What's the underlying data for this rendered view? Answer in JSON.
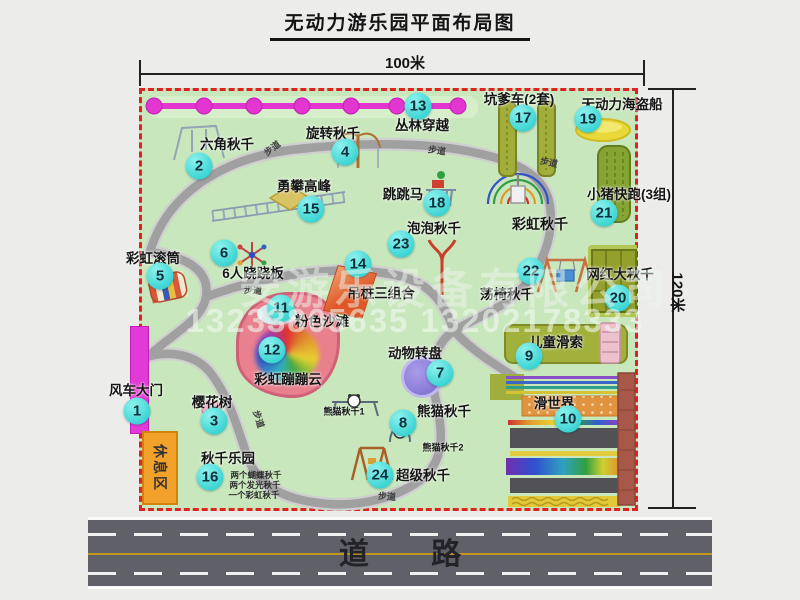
{
  "title": "无动力游乐园平面布局图",
  "dimensions": {
    "width_label": "100米",
    "height_label": "120米"
  },
  "road": {
    "label": "道 路"
  },
  "watermark": {
    "line1": "安游乐设备有限公司",
    "line2": "13233805635 13202178333"
  },
  "colors": {
    "map_bg": "#c9e7bd",
    "border_dash": "#dd2222",
    "badge": "#1cc9c9",
    "zipline": "#e335cf",
    "gate": "#e23ad6",
    "rest_area": "#f2a22b",
    "road": "#606068"
  },
  "map": {
    "rest_area_label": "休息区",
    "attractions": [
      {
        "num": "1",
        "label": "风车大门",
        "lx": 136,
        "ly": 389,
        "bx": 137,
        "by": 411
      },
      {
        "num": "2",
        "label": "六角秋千",
        "lx": 227,
        "ly": 143,
        "bx": 199,
        "by": 166
      },
      {
        "num": "3",
        "label": "樱花树",
        "lx": 212,
        "ly": 401,
        "bx": 214,
        "by": 421
      },
      {
        "num": "4",
        "label": "旋转秋千",
        "lx": 333,
        "ly": 132,
        "bx": 345,
        "by": 152
      },
      {
        "num": "5",
        "label": "彩虹滚筒",
        "lx": 153,
        "ly": 257,
        "bx": 160,
        "by": 276
      },
      {
        "num": "6",
        "label": "6人跷跷板",
        "lx": 253,
        "ly": 272,
        "bx": 224,
        "by": 253
      },
      {
        "num": "7",
        "label": "动物转盘",
        "lx": 415,
        "ly": 352,
        "bx": 440,
        "by": 373
      },
      {
        "num": "8",
        "label": "熊猫秋千",
        "lx": 444,
        "ly": 410,
        "bx": 403,
        "by": 423
      },
      {
        "num": "9",
        "label": "儿童滑索",
        "lx": 556,
        "ly": 341,
        "bx": 529,
        "by": 356
      },
      {
        "num": "10",
        "label": "滑世界",
        "lx": 554,
        "ly": 402,
        "bx": 568,
        "by": 419
      },
      {
        "num": "11",
        "label": "粉色沙滩",
        "lx": 322,
        "ly": 320,
        "bx": 281,
        "by": 308
      },
      {
        "num": "12",
        "label": "彩虹蹦蹦云",
        "lx": 288,
        "ly": 378,
        "bx": 272,
        "by": 350
      },
      {
        "num": "13",
        "label": "丛林穿越",
        "lx": 422,
        "ly": 124,
        "bx": 418,
        "by": 106
      },
      {
        "num": "14",
        "label": "吊桩三组合",
        "lx": 381,
        "ly": 292,
        "bx": 358,
        "by": 264
      },
      {
        "num": "15",
        "label": "勇攀高峰",
        "lx": 304,
        "ly": 185,
        "bx": 311,
        "by": 209
      },
      {
        "num": "16",
        "label": "秋千乐园",
        "lx": 228,
        "ly": 457,
        "bx": 210,
        "by": 477
      },
      {
        "num": "17",
        "label": "坑爹车(2套)",
        "lx": 519,
        "ly": 98,
        "bx": 523,
        "by": 118
      },
      {
        "num": "18",
        "label": "跳跳马",
        "lx": 403,
        "ly": 193,
        "bx": 437,
        "by": 203
      },
      {
        "num": "19",
        "label": "无动力海盗船",
        "lx": 622,
        "ly": 103,
        "bx": 588,
        "by": 119
      },
      {
        "num": "20",
        "label": "网红大秋千",
        "lx": 620,
        "ly": 273,
        "bx": 618,
        "by": 298
      },
      {
        "num": "21",
        "label": "小猪快跑(3组)",
        "lx": 629,
        "ly": 193,
        "bx": 604,
        "by": 213
      },
      {
        "num": "22",
        "label": "荡椅秋千",
        "lx": 507,
        "ly": 293,
        "bx": 531,
        "by": 271
      },
      {
        "num": "23",
        "label": "泡泡秋千",
        "lx": 434,
        "ly": 227,
        "bx": 401,
        "by": 244
      },
      {
        "num": "24",
        "label": "超级秋千",
        "lx": 423,
        "ly": 474,
        "bx": 380,
        "by": 475
      }
    ],
    "extra_labels": [
      {
        "text": "彩虹秋千",
        "x": 540,
        "y": 224,
        "size": 14
      },
      {
        "text": "熊猫秋千1",
        "x": 344,
        "y": 411,
        "size": 9
      },
      {
        "text": "熊猫秋千2",
        "x": 443,
        "y": 447,
        "size": 9
      }
    ],
    "swing_park_notes": [
      {
        "text": "两个蝴蝶秋千",
        "x": 256,
        "y": 475
      },
      {
        "text": "两个发光秋千",
        "x": 255,
        "y": 485
      },
      {
        "text": "一个彩虹秋千",
        "x": 254,
        "y": 495
      }
    ],
    "walkway_labels": [
      {
        "text": "步道",
        "x": 272,
        "y": 148,
        "r": -38
      },
      {
        "text": "步道",
        "x": 437,
        "y": 150,
        "r": 8
      },
      {
        "text": "步道",
        "x": 549,
        "y": 162,
        "r": 12
      },
      {
        "text": "步道",
        "x": 253,
        "y": 290,
        "r": 4
      },
      {
        "text": "步道",
        "x": 259,
        "y": 419,
        "r": 72
      },
      {
        "text": "步道",
        "x": 387,
        "y": 496,
        "r": 4
      }
    ]
  }
}
